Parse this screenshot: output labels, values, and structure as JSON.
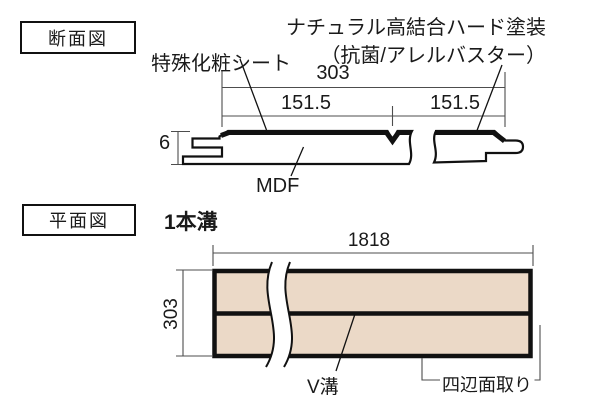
{
  "section_view": {
    "tag": "断面図",
    "labels": {
      "sheet": "特殊化粧シート",
      "coating_line1": "ナチュラル高結合ハード塗装",
      "coating_line2": "（抗菌/アレルバスター）",
      "core": "MDF"
    },
    "dimensions": {
      "width_total": "303",
      "width_left": "151.5",
      "width_right": "151.5",
      "thickness": "6"
    }
  },
  "plan_view": {
    "tag": "平面図",
    "title": "1本溝",
    "labels": {
      "groove": "V溝",
      "chamfer": "四辺面取り"
    },
    "dimensions": {
      "length": "1818",
      "width": "303"
    }
  },
  "colors": {
    "background": "#ffffff",
    "line": "#111111",
    "dim_line": "#4d4d4d",
    "text": "#1a1a1a",
    "board_fill": "#ebd9c7"
  }
}
